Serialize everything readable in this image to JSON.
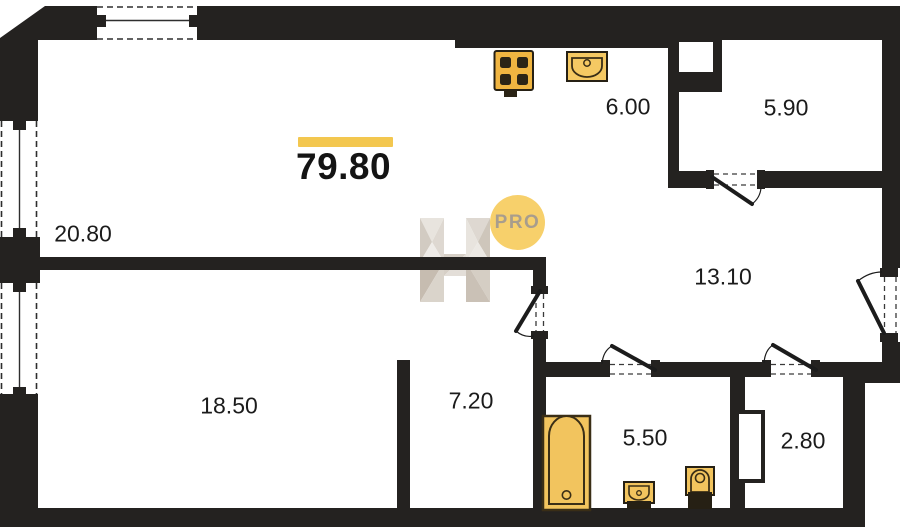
{
  "plan": {
    "total_area": "79.80",
    "watermark_text": "PRO",
    "rooms": [
      {
        "name": "living-room",
        "area": "20.80"
      },
      {
        "name": "bedroom",
        "area": "18.50"
      },
      {
        "name": "corridor",
        "area": "7.20"
      },
      {
        "name": "kitchen",
        "area": "6.00"
      },
      {
        "name": "wardrobe",
        "area": "5.90"
      },
      {
        "name": "hallway",
        "area": "13.10"
      },
      {
        "name": "bathroom",
        "area": "5.50"
      },
      {
        "name": "storage",
        "area": "2.80"
      }
    ],
    "colors": {
      "wall": "#242220",
      "accent_yellow": "#f3c74f",
      "fixture_fill": "#f2c45e",
      "fixture_stroke": "#3a2e16",
      "badge_fill": "#f7d06b",
      "badge_text": "#a89d8d"
    }
  }
}
